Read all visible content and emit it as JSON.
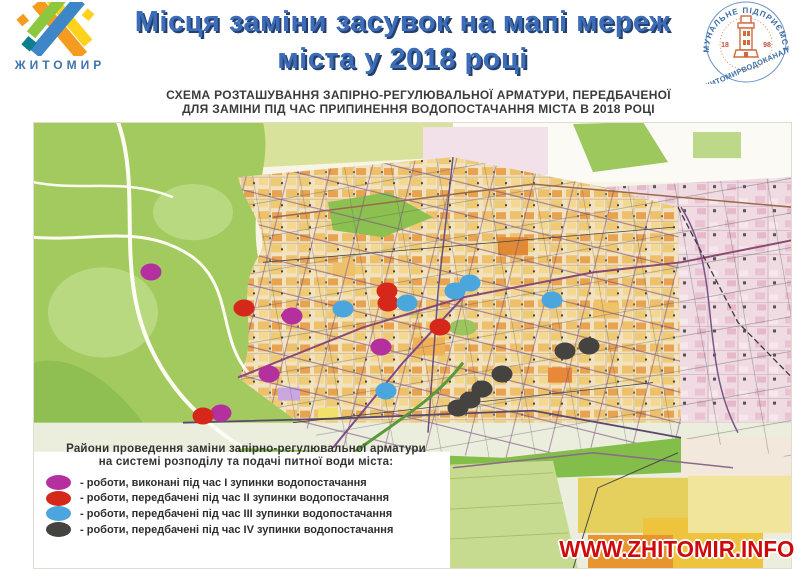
{
  "header": {
    "city_logo": {
      "city_name": "ЖИТОМИР"
    },
    "title_line1": "Місця заміни засувок на мапі мереж",
    "title_line2": "міста у 2018 році",
    "seal": {
      "arc_top": "КОМУНАЛЬНЕ ПІДПРИЄМСТВО",
      "name_bottom": "ЖИТОМИРВОДОКАНАЛ",
      "year_left": "18",
      "year_right": "98"
    }
  },
  "map": {
    "subtitle_line1": "СХЕМА РОЗТАШУВАННЯ ЗАПІРНО-РЕГУЛЮВАЛЬНОЇ АРМАТУРИ, ПЕРЕДБАЧЕНОЇ",
    "subtitle_line2": "ДЛЯ ЗАМІНИ ПІД ЧАС ПРИПИНЕННЯ ВОДОПОСТАЧАННЯ МІСТА В 2018 РОЦІ",
    "markers": [
      {
        "id": "stop-1",
        "color": "#b5309f",
        "points": [
          [
            118,
            150
          ],
          [
            259,
            194
          ],
          [
            348,
            225
          ],
          [
            236,
            252
          ],
          [
            188,
            291
          ]
        ]
      },
      {
        "id": "stop-2",
        "color": "#d6281a",
        "points": [
          [
            354,
            169
          ],
          [
            355,
            181
          ],
          [
            211,
            186
          ],
          [
            407,
            205
          ],
          [
            170,
            294
          ]
        ]
      },
      {
        "id": "stop-3",
        "color": "#4ba6dd",
        "points": [
          [
            437,
            161
          ],
          [
            422,
            169
          ],
          [
            374,
            181
          ],
          [
            310,
            187
          ],
          [
            519,
            178
          ],
          [
            353,
            269
          ]
        ]
      },
      {
        "id": "stop-4",
        "color": "#45433f",
        "points": [
          [
            556,
            224
          ],
          [
            532,
            229
          ],
          [
            469,
            252
          ],
          [
            449,
            267
          ],
          [
            437,
            278
          ],
          [
            425,
            286
          ]
        ]
      }
    ]
  },
  "legend": {
    "title_line1": "Райони проведення заміни запірно-регулювальної арматури",
    "title_line2": "на системі розподілу та подачі питної води міста:",
    "items": [
      {
        "color": "#b5309f",
        "label": "- роботи, виконані під час I зупинки водопостачання"
      },
      {
        "color": "#d6281a",
        "label": "- роботи, передбачені під час II зупинки водопостачання"
      },
      {
        "color": "#4ba6dd",
        "label": "- роботи, передбачені під час III зупинки водопостачання"
      },
      {
        "color": "#45433f",
        "label": "- роботи, передбачені під час IV зупинки водопостачання"
      }
    ]
  },
  "watermark": "WWW.ZHITOMIR.INFO",
  "colors": {
    "title_blue": "#3d6db8",
    "title_shadow": "#23406e",
    "seal_blue": "#3b6ea5",
    "seal_orange": "#cf6a3c",
    "watermark_red": "#cf0a0a"
  }
}
